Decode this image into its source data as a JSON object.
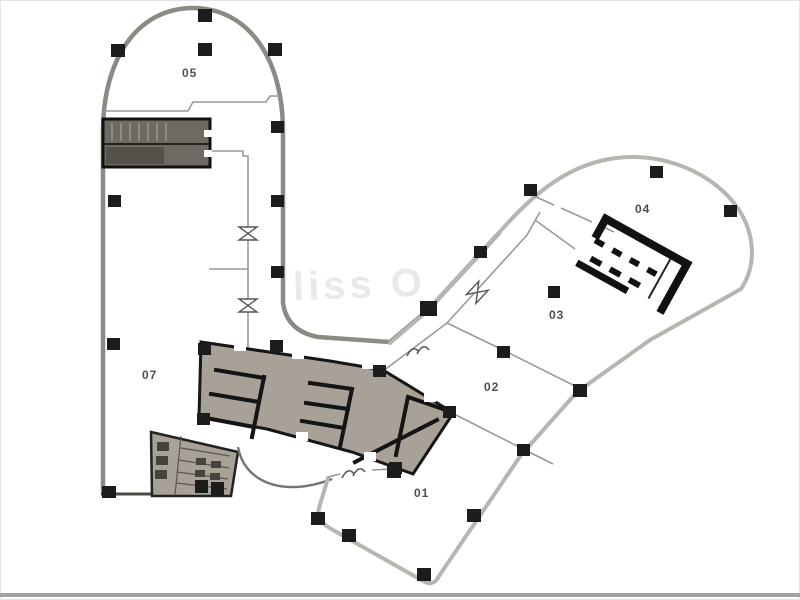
{
  "diagram": {
    "type": "floor-plan",
    "description": "Office building floor plan with two wings joined by a shaded service core"
  },
  "rooms": [
    {
      "id": "room-05",
      "label": "05"
    },
    {
      "id": "room-07",
      "label": "07"
    },
    {
      "id": "room-04",
      "label": "04"
    },
    {
      "id": "room-03",
      "label": "03"
    },
    {
      "id": "room-02",
      "label": "02"
    },
    {
      "id": "room-01",
      "label": "01"
    }
  ],
  "watermark": {
    "text": "liss O"
  },
  "colors": {
    "background": "#ffffff",
    "wall_dark": "#8b8b83",
    "wall_light": "#b6b6b0",
    "wall_thin": "#9a9a94",
    "column": "#1c1c1c",
    "core_fill": "#a8a198",
    "core_outline": "#161616",
    "stair_fill": "#6e6963",
    "label": "#4f4f4f",
    "border_bottom": "#a2a2a0",
    "watermark": "#e9e9e7"
  }
}
